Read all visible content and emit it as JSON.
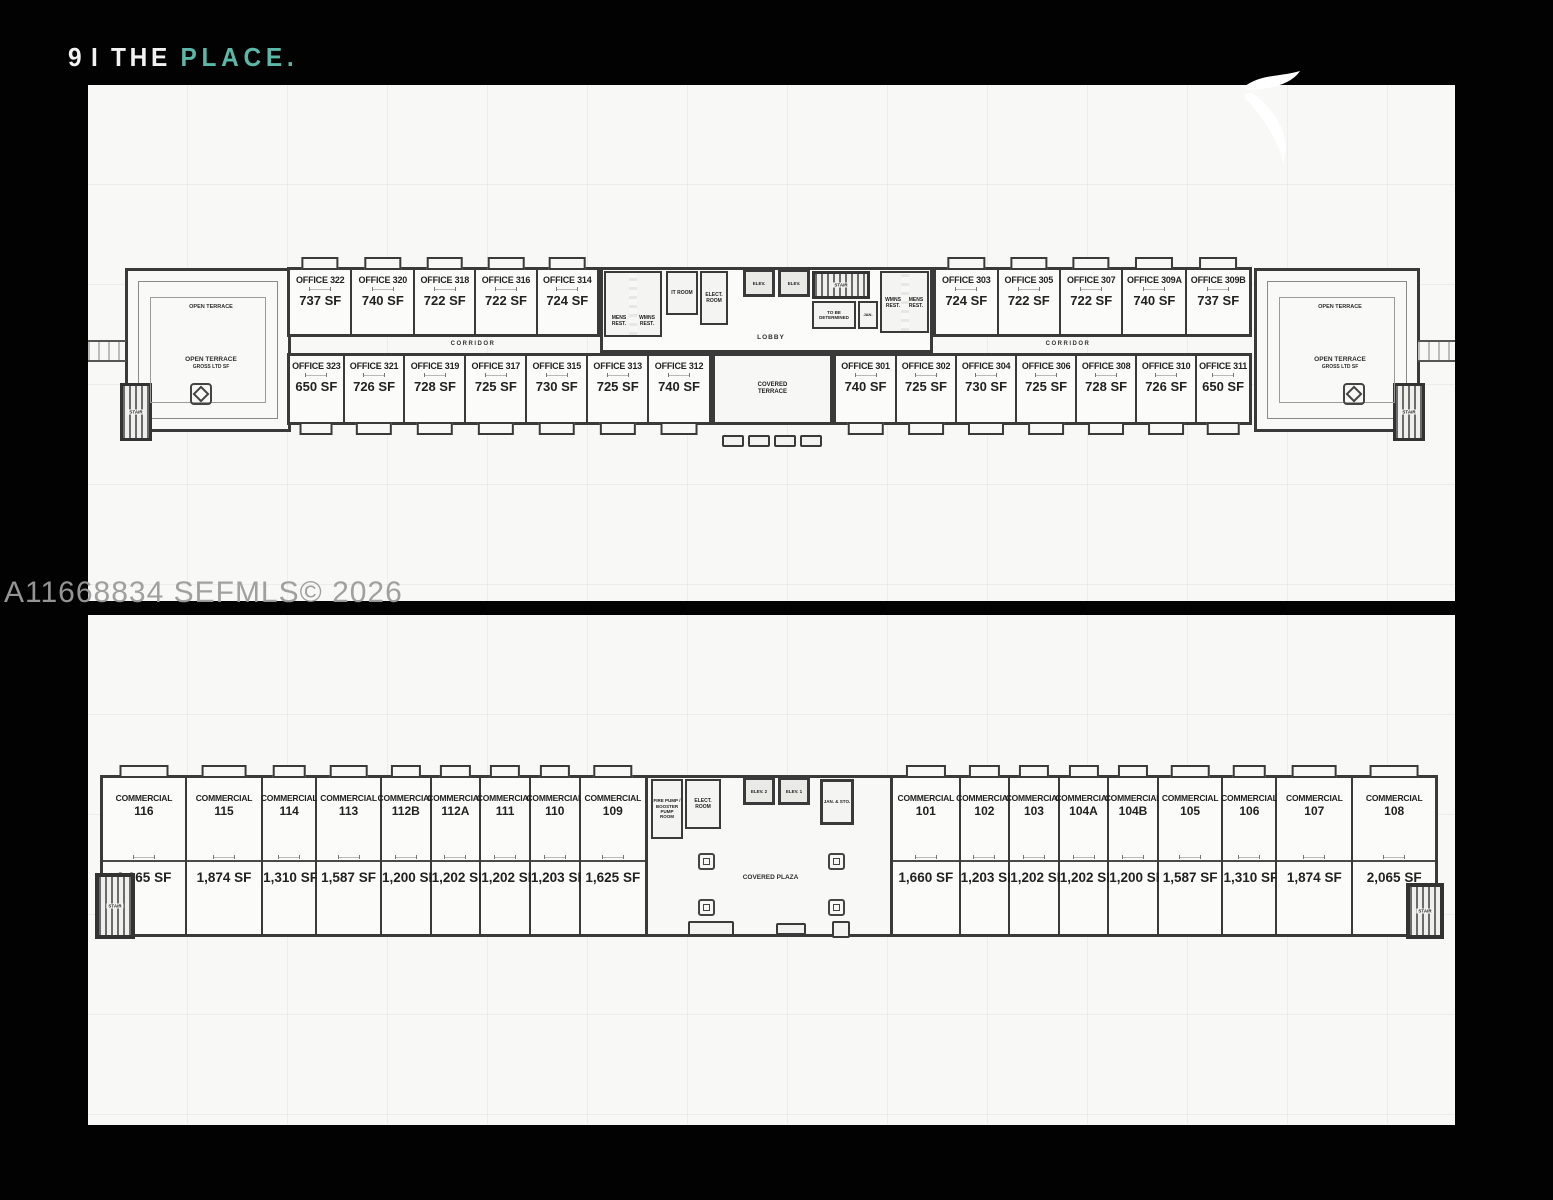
{
  "page": {
    "title_number": "9",
    "title_divider": "I",
    "title_word": "THE",
    "title_accent": "PLACE.",
    "watermark": "A11668834  SEFMLS© 2026",
    "accent_color": "#5bb7a8",
    "logo_icon": "swoosh-logo"
  },
  "office_floor": {
    "top_left": [
      {
        "name": "OFFICE 322",
        "sf": "737 SF"
      },
      {
        "name": "OFFICE 320",
        "sf": "740 SF"
      },
      {
        "name": "OFFICE 318",
        "sf": "722 SF"
      },
      {
        "name": "OFFICE 316",
        "sf": "722 SF"
      },
      {
        "name": "OFFICE 314",
        "sf": "724 SF"
      }
    ],
    "top_right": [
      {
        "name": "OFFICE 303",
        "sf": "724 SF"
      },
      {
        "name": "OFFICE 305",
        "sf": "722 SF"
      },
      {
        "name": "OFFICE 307",
        "sf": "722 SF"
      },
      {
        "name": "OFFICE 309A",
        "sf": "740 SF"
      },
      {
        "name": "OFFICE 309B",
        "sf": "737 SF"
      }
    ],
    "bottom_left": [
      {
        "name": "OFFICE 323",
        "sf": "650 SF"
      },
      {
        "name": "OFFICE 321",
        "sf": "726 SF"
      },
      {
        "name": "OFFICE 319",
        "sf": "728 SF"
      },
      {
        "name": "OFFICE 317",
        "sf": "725 SF"
      },
      {
        "name": "OFFICE 315",
        "sf": "730 SF"
      },
      {
        "name": "OFFICE 313",
        "sf": "725 SF"
      },
      {
        "name": "OFFICE 312",
        "sf": "740 SF"
      }
    ],
    "bottom_right": [
      {
        "name": "OFFICE 301",
        "sf": "740 SF"
      },
      {
        "name": "OFFICE 302",
        "sf": "725 SF"
      },
      {
        "name": "OFFICE 304",
        "sf": "730 SF"
      },
      {
        "name": "OFFICE 306",
        "sf": "725 SF"
      },
      {
        "name": "OFFICE 308",
        "sf": "728 SF"
      },
      {
        "name": "OFFICE 310",
        "sf": "726 SF"
      },
      {
        "name": "OFFICE 311",
        "sf": "650 SF"
      }
    ],
    "labels": {
      "corridor": "CORRIDOR",
      "lobby": "LOBBY",
      "covered_terrace": "COVERED TERRACE",
      "open_terrace": "OPEN TERRACE",
      "terrace_gross": "GROSS LTD SF",
      "stair": "STAIR",
      "mens_rest": "MENS REST.",
      "wmns_rest": "WMNS REST.",
      "it_room": "IT ROOM",
      "elect_room": "ELECT. ROOM",
      "elev": "ELEV.",
      "to_be_determined": "TO BE DETERMINED",
      "jan": "JAN."
    }
  },
  "commercial_floor": {
    "left": [
      {
        "label": "COMMERCIAL",
        "num": "116",
        "sf": "2,065 SF"
      },
      {
        "label": "COMMERCIAL",
        "num": "115",
        "sf": "1,874 SF"
      },
      {
        "label": "COMMERCIAL",
        "num": "114",
        "sf": "1,310 SF"
      },
      {
        "label": "COMMERCIAL",
        "num": "113",
        "sf": "1,587 SF"
      },
      {
        "label": "COMMERCIAL",
        "num": "112B",
        "sf": "1,200 SF"
      },
      {
        "label": "COMMERCIAL",
        "num": "112A",
        "sf": "1,202 SF"
      },
      {
        "label": "COMMERCIAL",
        "num": "111",
        "sf": "1,202 SF"
      },
      {
        "label": "COMMERCIAL",
        "num": "110",
        "sf": "1,203 SF"
      },
      {
        "label": "COMMERCIAL",
        "num": "109",
        "sf": "1,625 SF"
      }
    ],
    "right": [
      {
        "label": "COMMERCIAL",
        "num": "101",
        "sf": "1,660 SF"
      },
      {
        "label": "COMMERCIAL",
        "num": "102",
        "sf": "1,203 SF"
      },
      {
        "label": "COMMERCIAL",
        "num": "103",
        "sf": "1,202 SF"
      },
      {
        "label": "COMMERCIAL",
        "num": "104A",
        "sf": "1,202 SF"
      },
      {
        "label": "COMMERCIAL",
        "num": "104B",
        "sf": "1,200 SF"
      },
      {
        "label": "COMMERCIAL",
        "num": "105",
        "sf": "1,587 SF"
      },
      {
        "label": "COMMERCIAL",
        "num": "106",
        "sf": "1,310 SF"
      },
      {
        "label": "COMMERCIAL",
        "num": "107",
        "sf": "1,874 SF"
      },
      {
        "label": "COMMERCIAL",
        "num": "108",
        "sf": "2,065 SF"
      }
    ],
    "labels": {
      "fire_pump": "FIRE PUMP / BOOSTER PUMP ROOM",
      "elect_room": "ELECT. ROOM",
      "elev2": "ELEV. 2",
      "elev1": "ELEV. 1",
      "plaza": "COVERED PLAZA",
      "jan_sto": "JAN. & STO.",
      "stair": "STAIR"
    }
  }
}
